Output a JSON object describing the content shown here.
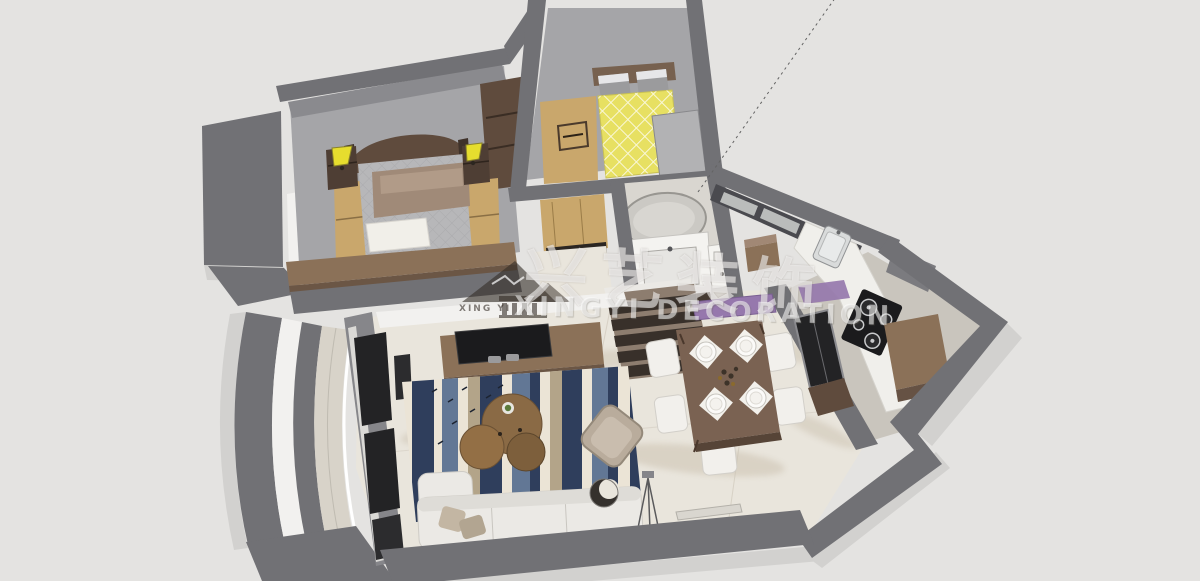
{
  "watermark": {
    "logo_text": "XING YI",
    "chinese_text": "兴艺装饰",
    "latin_text": "XINGYI DECORATION"
  },
  "colors": {
    "bg": "#e4e3e1",
    "wall": "#717175",
    "wall-face": "#8a8a8e",
    "bevel": "#d2d1cf",
    "white-face": "#f2f1ef",
    "marble": "#e9e5dc",
    "marble-vein": "#b9ab94",
    "floor-gray": "#a5a5a8",
    "carpet-gray": "#b7b7b9",
    "wood-light": "#c9a76c",
    "wood-mid": "#8b7158",
    "wood-dark": "#5f4b3d",
    "table-brown": "#7a6252",
    "bed-yellow": "#e7e062",
    "lamp-yellow": "#e6dd2e",
    "pillow-gray": "#9b9b9d",
    "blanket-brown": "#a08a78",
    "sofa-white": "#ebe9e5",
    "chair-white": "#f2f0ec",
    "rug-cream": "#ebe4d6",
    "rug-navy": "#2f3e5c",
    "rug-blue": "#627795",
    "rug-beige": "#b3a489",
    "accent-purple": "#9678ad",
    "appliance-black": "#1b1b1d",
    "glass-dark": "#232325",
    "steel": "#d9dbdb",
    "watermark-white": "rgba(255,255,255,0.55)",
    "watermark-dark": "rgba(52,45,38,0.6)"
  }
}
